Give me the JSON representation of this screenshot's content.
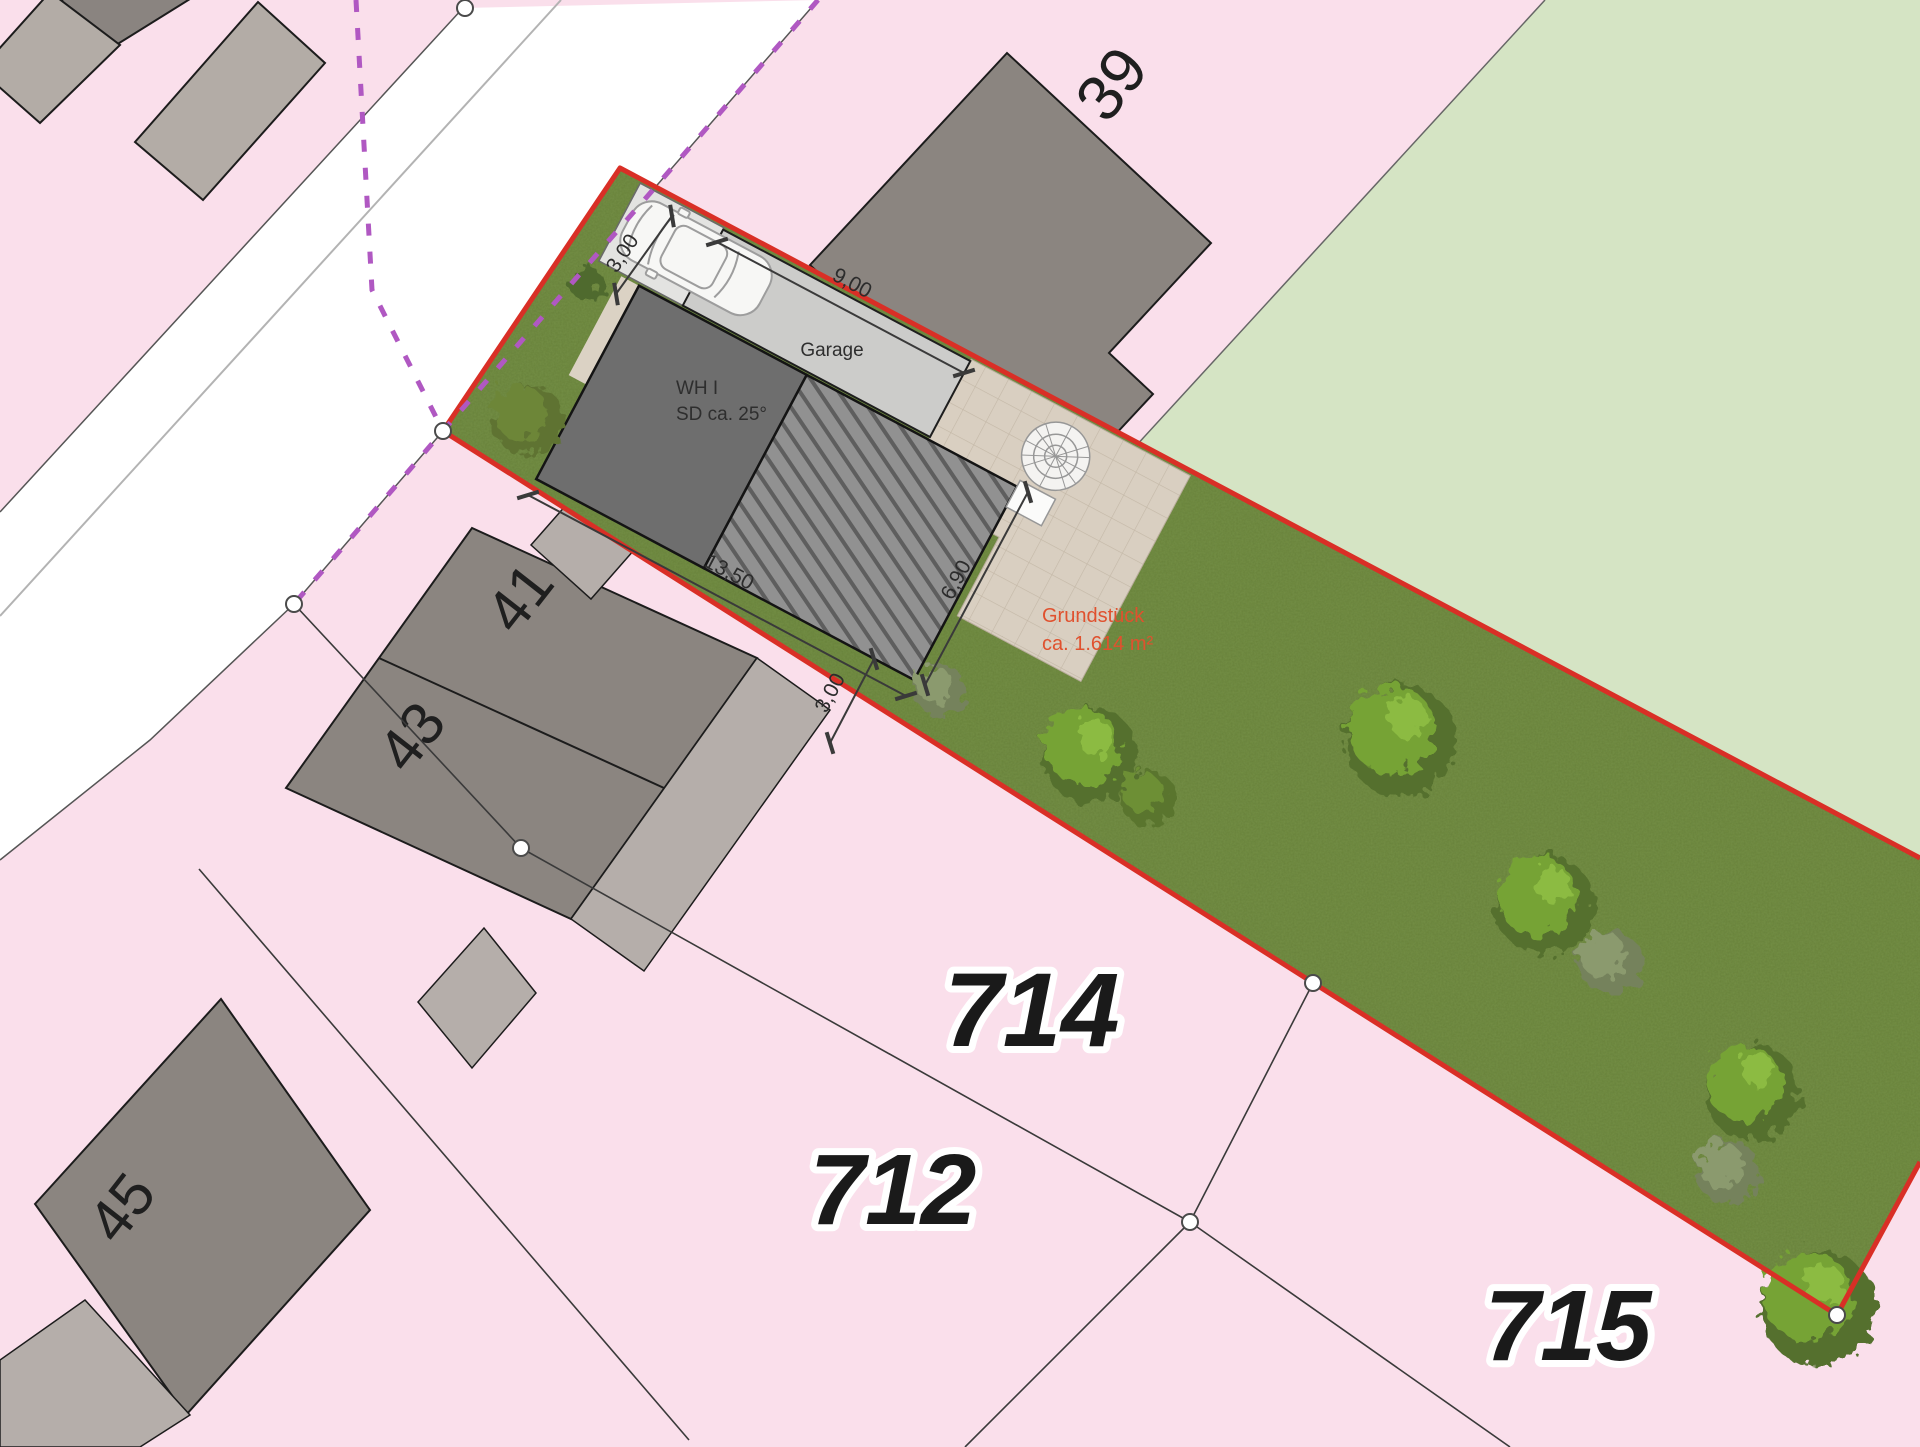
{
  "colors": {
    "pink": "#fadfeb",
    "light_green": "#d5e4c4",
    "road_white": "#ffffff",
    "grass": "#748f46",
    "red_boundary": "#d92f26",
    "purple_boundary": "#b058c2",
    "building_gray": "#8b8580",
    "building_light": "#b5aeaa",
    "house_dark": "#6e6e6e",
    "garage_gray": "#ccccca",
    "paving": "#d9cfc1",
    "label_dark": "#1f1f1f",
    "area_text": "#e0512e"
  },
  "parcels": {
    "p714": "714",
    "p712": "712",
    "p715": "715"
  },
  "house_numbers": {
    "n39": "39",
    "n41": "41",
    "n43": "43",
    "n45": "45"
  },
  "plot": {
    "area_label_line1": "Grundstück",
    "area_label_line2": "ca. 1.614 m²"
  },
  "planned": {
    "house_line1": "WH I",
    "house_line2": "SD ca. 25°",
    "garage_label": "Garage"
  },
  "dimensions": {
    "d1": "3,00",
    "d2": "9,00",
    "d3": "13,50",
    "d4": "6,90",
    "d5": "3,00"
  }
}
